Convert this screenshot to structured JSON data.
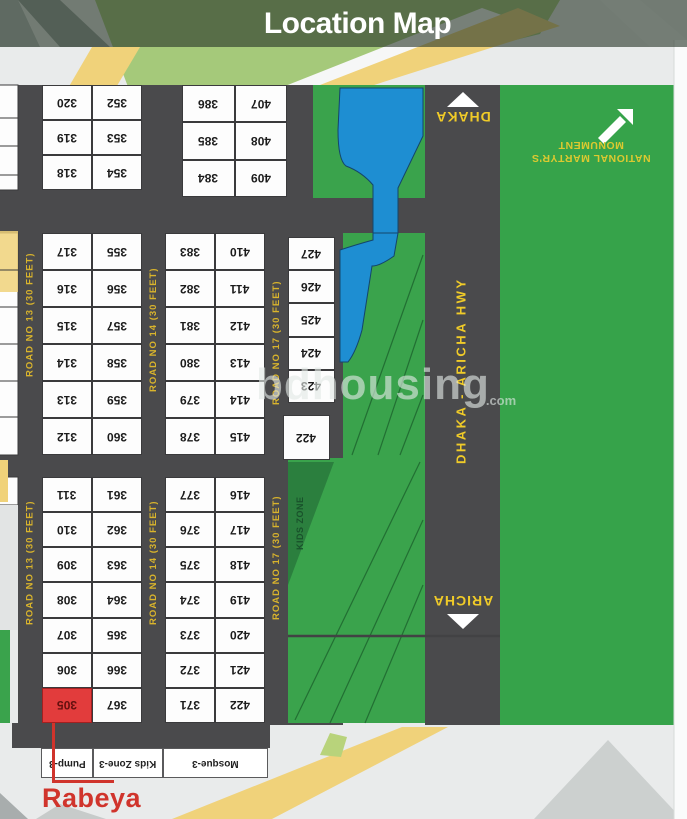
{
  "title": "Location Map",
  "watermark": {
    "text": "bdhousing",
    "suffix": ".com"
  },
  "highway": {
    "name": "DHAKA - ARICHA HWY",
    "north_label": "DHAKA",
    "south_label": "ARICHA"
  },
  "monument": {
    "line1": "NATIONAL MARTYR'S",
    "line2": "MONUMENT"
  },
  "road_labels": {
    "r13": "ROAD NO 13 (30 FEET)",
    "r14": "ROAD NO 14 (30 FEET)",
    "r17": "ROAD NO 17 (30 FEET)"
  },
  "kids_zone_label": "KIDS ZONE",
  "facilities": [
    "Pump-3",
    "Kids Zone-3",
    "Mosque-3"
  ],
  "highlight": {
    "plot": "305",
    "label": "Rabeya"
  },
  "plots": {
    "top_left": [
      [
        "320",
        "352"
      ],
      [
        "319",
        "353"
      ],
      [
        "318",
        "354"
      ]
    ],
    "top_mid": [
      [
        "386",
        "407"
      ],
      [
        "385",
        "408"
      ],
      [
        "384",
        "409"
      ]
    ],
    "mid_left": [
      [
        "317",
        "355"
      ],
      [
        "316",
        "356"
      ],
      [
        "315",
        "357"
      ],
      [
        "314",
        "358"
      ],
      [
        "313",
        "359"
      ],
      [
        "312",
        "360"
      ]
    ],
    "mid_mid": [
      [
        "383",
        "410"
      ],
      [
        "382",
        "411"
      ],
      [
        "381",
        "412"
      ],
      [
        "380",
        "413"
      ],
      [
        "379",
        "414"
      ],
      [
        "378",
        "415"
      ]
    ],
    "right_col": [
      "427",
      "426",
      "425",
      "424",
      "423"
    ],
    "right_col_lone": "422",
    "low_left": [
      [
        "311",
        "361"
      ],
      [
        "310",
        "362"
      ],
      [
        "309",
        "363"
      ],
      [
        "308",
        "364"
      ],
      [
        "307",
        "365"
      ],
      [
        "306",
        "366"
      ],
      [
        "305",
        "367"
      ]
    ],
    "low_mid": [
      [
        "377",
        "416"
      ],
      [
        "376",
        "417"
      ],
      [
        "375",
        "418"
      ],
      [
        "374",
        "419"
      ],
      [
        "373",
        "420"
      ],
      [
        "372",
        "421"
      ],
      [
        "371",
        "422"
      ]
    ]
  },
  "colors": {
    "road": "#4a4a4c",
    "map_green": "#36a34a",
    "water_blue": "#1e8ed2",
    "highlight_red": "#e23c3c",
    "accent_yellow": "#f0cb28",
    "road_label_yellow": "#d9b42c"
  }
}
